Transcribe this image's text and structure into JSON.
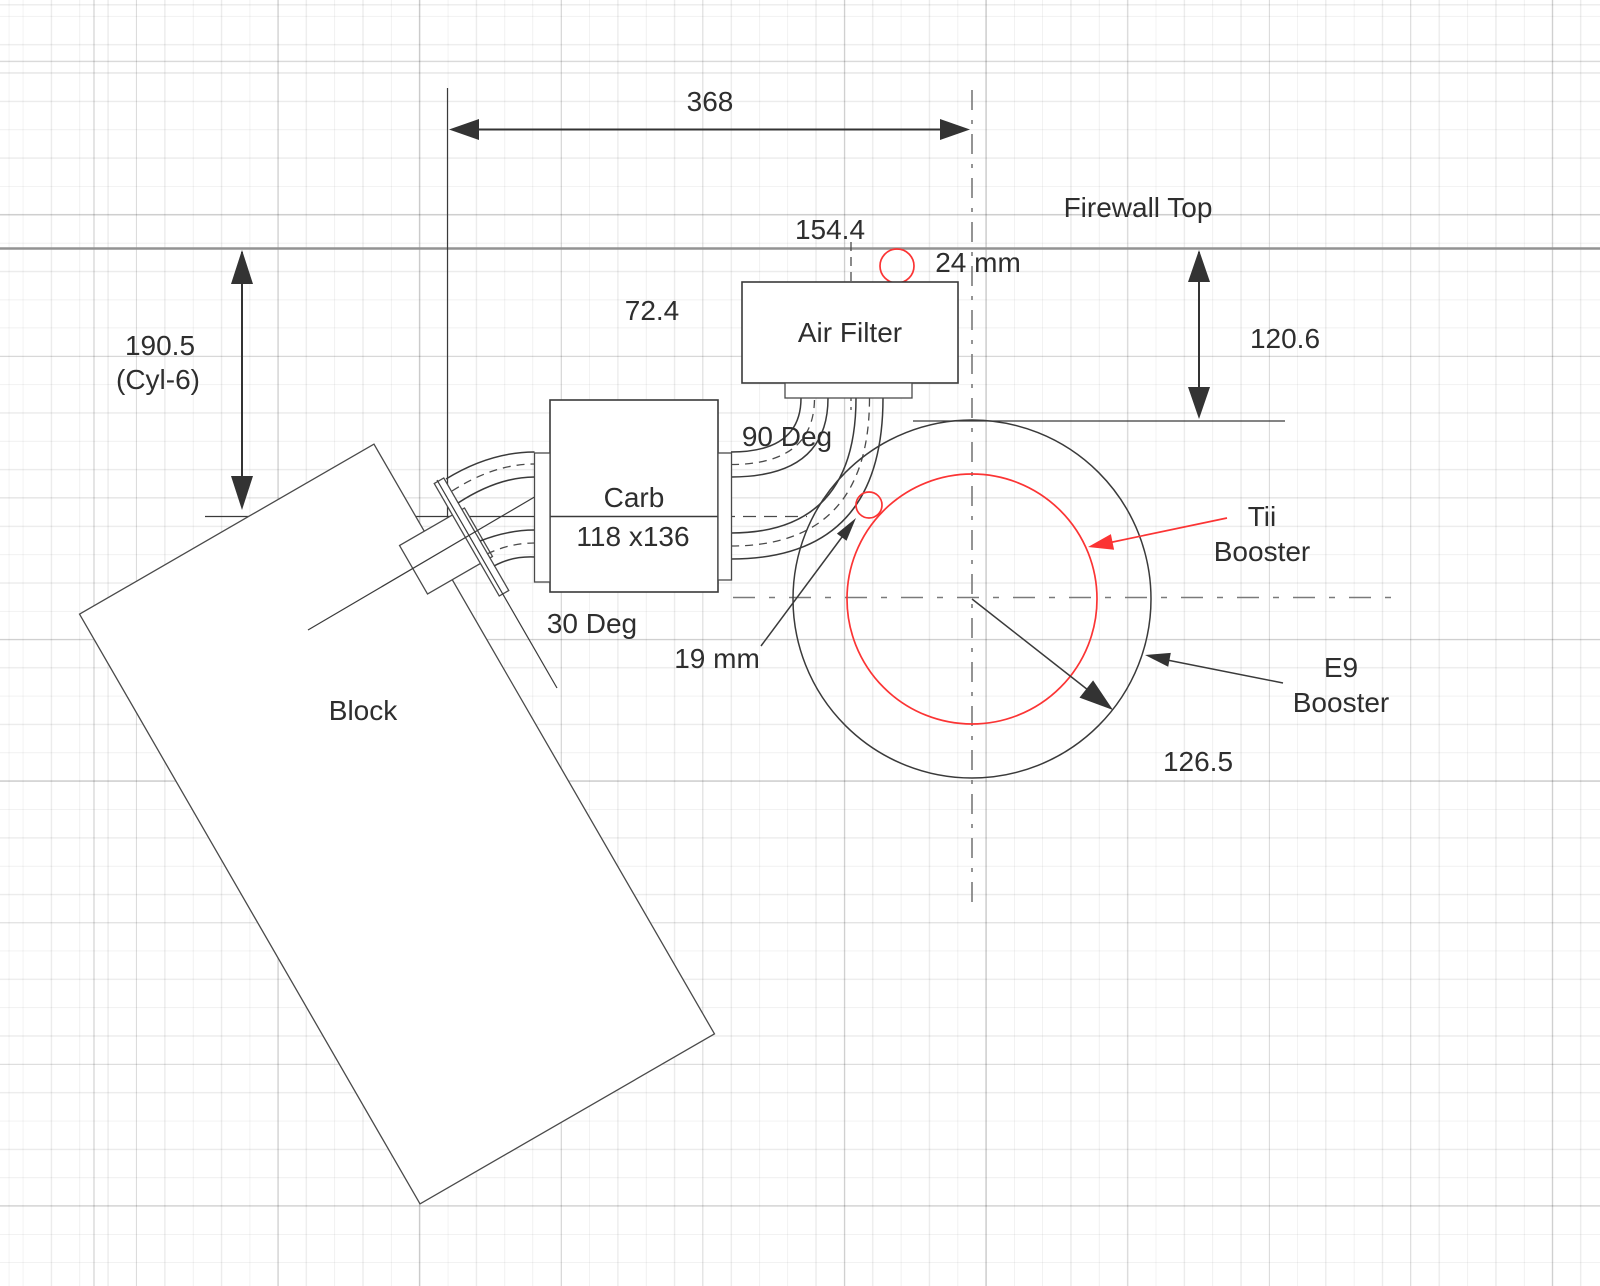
{
  "diagram": {
    "title_note": "Engine bay packaging sketch",
    "labels": {
      "dim_width": "368",
      "dim_air_filter": "154.4",
      "firewall_top": "Firewall Top",
      "dim_hole_24": "24 mm",
      "dim_head_to_carb": "72.4",
      "dim_firewall_to_booster": "120.6",
      "dim_cyl6": "190.5",
      "dim_cyl6_note": "(Cyl-6)",
      "air_filter": "Air Filter",
      "bend_90": "90 Deg",
      "carb_name": "Carb",
      "carb_size": "118 x136",
      "tilt_30": "30 Deg",
      "dim_hose_19": "19 mm",
      "tii_booster_line1": "Tii",
      "tii_booster_line2": "Booster",
      "e9_booster_line1": "E9",
      "e9_booster_line2": "Booster",
      "dim_booster_radius": "126.5",
      "block": "Block"
    },
    "colors": {
      "accent_red": "#fb3434",
      "line_dark": "#3a3a3a",
      "centerline_gray": "#7a7a7a",
      "firewall_gray": "#939393"
    }
  }
}
